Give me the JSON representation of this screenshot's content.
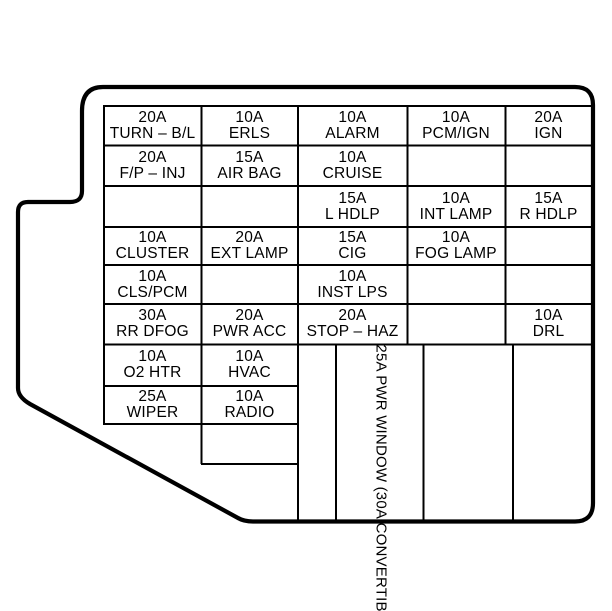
{
  "diagram": {
    "colors": {
      "line": "#000000",
      "background": "#ffffff",
      "text": "#000000"
    },
    "fuses": [
      {
        "amp": "20A",
        "label": "TURN – B/L"
      },
      {
        "amp": "10A",
        "label": "ERLS"
      },
      {
        "amp": "10A",
        "label": "ALARM"
      },
      {
        "amp": "10A",
        "label": "PCM/IGN"
      },
      {
        "amp": "20A",
        "label": "IGN"
      },
      {
        "amp": "20A",
        "label": "F/P – INJ"
      },
      {
        "amp": "15A",
        "label": "AIR BAG"
      },
      {
        "amp": "10A",
        "label": "CRUISE"
      },
      {
        "amp": "15A",
        "label": "L HDLP"
      },
      {
        "amp": "10A",
        "label": "INT LAMP"
      },
      {
        "amp": "15A",
        "label": "R HDLP"
      },
      {
        "amp": "10A",
        "label": "CLUSTER"
      },
      {
        "amp": "20A",
        "label": "EXT LAMP"
      },
      {
        "amp": "15A",
        "label": "CIG"
      },
      {
        "amp": "10A",
        "label": "FOG LAMP"
      },
      {
        "amp": "10A",
        "label": "CLS/PCM"
      },
      {
        "amp": "10A",
        "label": "INST LPS"
      },
      {
        "amp": "30A",
        "label": "RR DFOG"
      },
      {
        "amp": "20A",
        "label": "PWR ACC"
      },
      {
        "amp": "20A",
        "label": "STOP – HAZ"
      },
      {
        "amp": "10A",
        "label": "DRL"
      },
      {
        "amp": "10A",
        "label": "O2 HTR"
      },
      {
        "amp": "10A",
        "label": "HVAC"
      },
      {
        "amp": "25A",
        "label": "WIPER"
      },
      {
        "amp": "10A",
        "label": "RADIO"
      }
    ],
    "power_window_fuse": {
      "amp": "25A",
      "label": "PWR WINDOW",
      "note": "(30A CONVERTIBLE)"
    }
  }
}
